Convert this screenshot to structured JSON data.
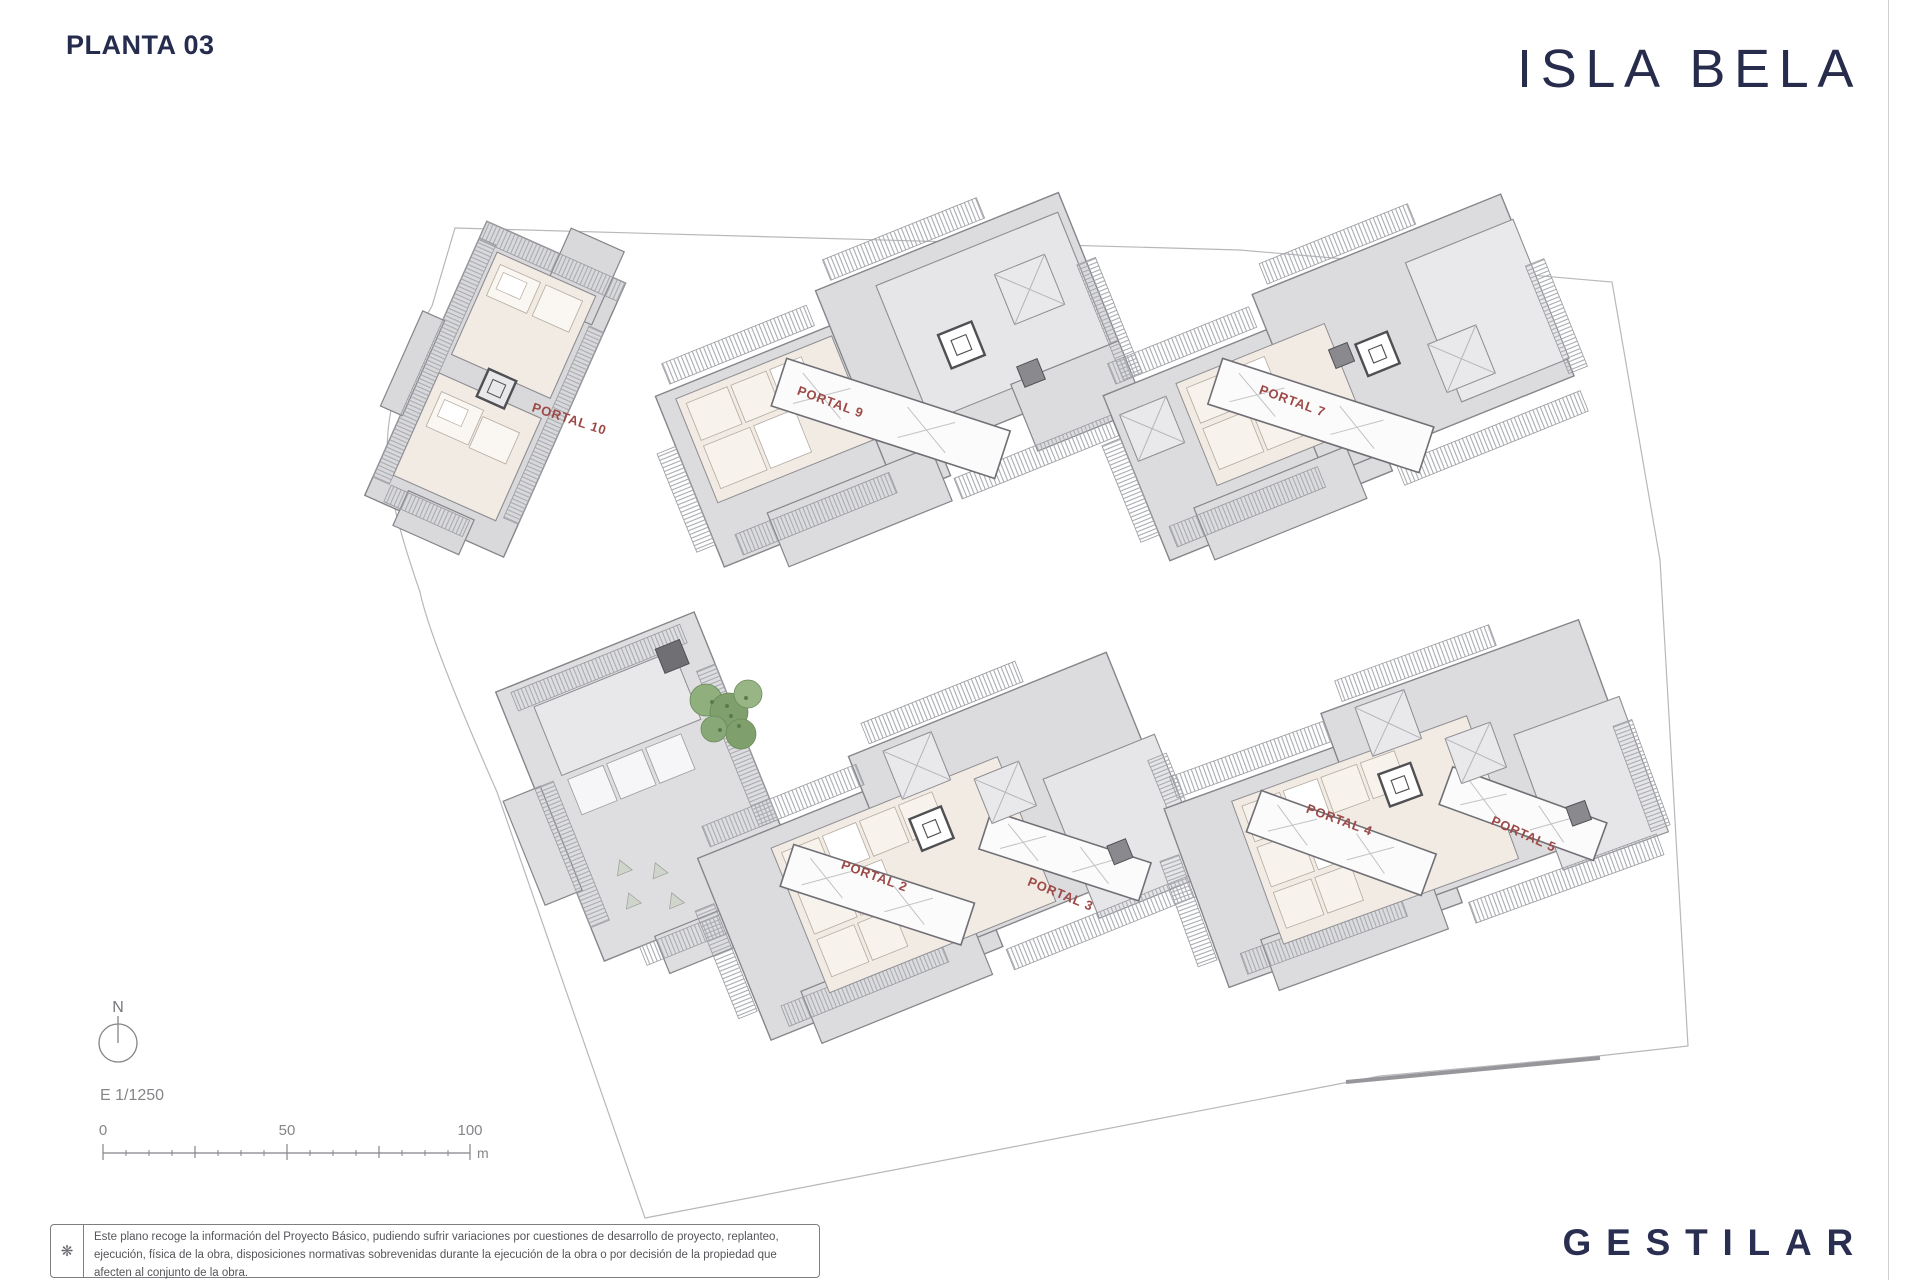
{
  "header": {
    "sheet_title": "PLANTA 03",
    "brand_logo": "ISLA BELA"
  },
  "map": {
    "north_label": "N",
    "scale_text": "E 1/1250",
    "scale_bar": {
      "tick_labels": [
        "0",
        "50",
        "100"
      ],
      "unit": "m"
    },
    "portals": [
      {
        "label": "PORTAL 10"
      },
      {
        "label": "PORTAL 9"
      },
      {
        "label": "PORTAL 7"
      },
      {
        "label": "PORTAL 2"
      },
      {
        "label": "PORTAL 3"
      },
      {
        "label": "PORTAL 4"
      },
      {
        "label": "PORTAL 5"
      }
    ],
    "colors": {
      "portal_label_red": "#9c4a47",
      "roof_gray": "#dcdcdf",
      "terrace_gray": "#e6e6e9",
      "room_cream": "#f2ebe3",
      "wall_gray": "#6f6f75",
      "boundary_gray": "#b8b8bc",
      "tree_green": "#7fa06c",
      "brand_navy": "#272c4d"
    }
  },
  "footer": {
    "developer_logo": "GESTILAR",
    "disclaimer_icon": "flower-asterisk-icon",
    "disclaimer": "Este plano recoge la información del Proyecto Básico, pudiendo sufrir variaciones por cuestiones de desarrollo de proyecto, replanteo, ejecución, física de la obra, disposiciones normativas sobrevenidas durante la ejecución de la obra o por decisión de la propiedad que afecten al conjunto de la obra."
  }
}
